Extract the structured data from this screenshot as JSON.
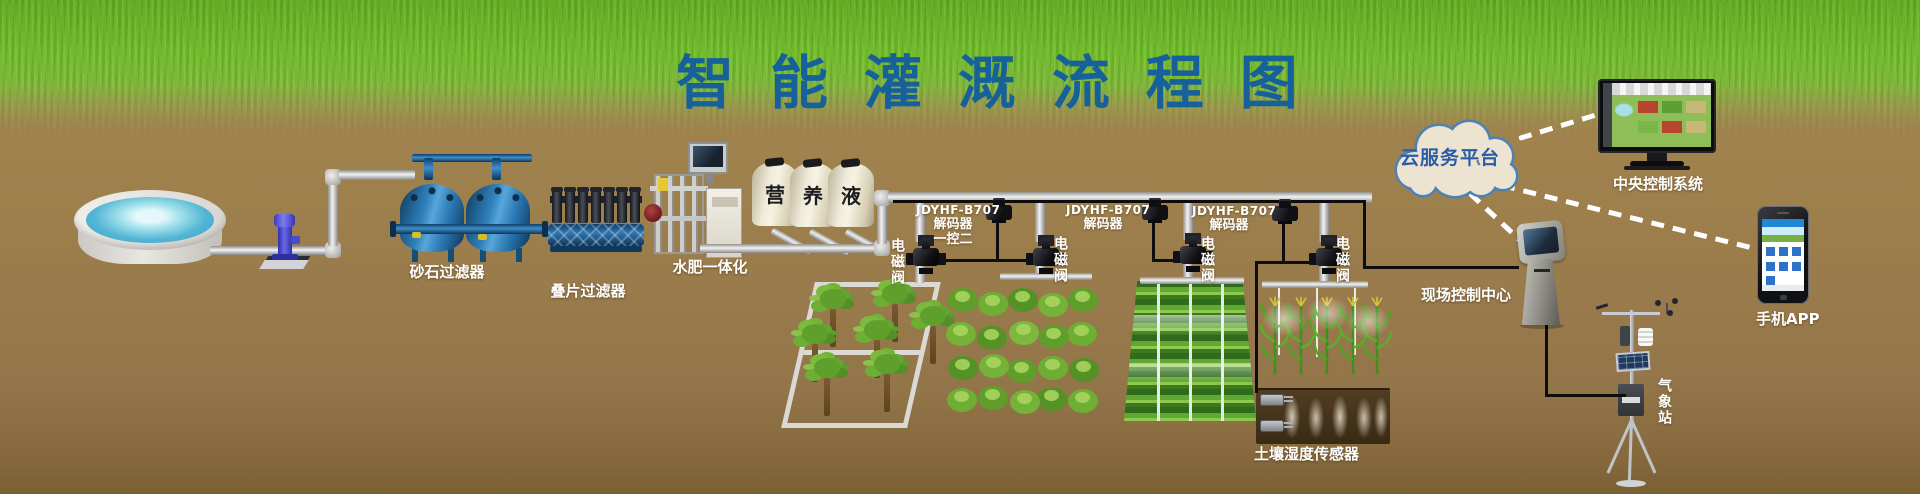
{
  "title": "智能灌溉流程图",
  "stages": {
    "sand_filter": "砂石过滤器",
    "disc_filter": "叠片过滤器",
    "fertilizer_machine": "水肥一体化",
    "solenoid_valve": "电磁阀",
    "soil_sensor": "土壤湿度传感器"
  },
  "nutrient_tanks": [
    "营",
    "养",
    "液"
  ],
  "decoders": [
    {
      "model": "JDYHF-B707",
      "name": "解码器",
      "mode": "一控二"
    },
    {
      "model": "JDYHF-B707",
      "name": "解码器"
    },
    {
      "model": "JDYHF-B707",
      "name": "解码器"
    }
  ],
  "platform": {
    "cloud": "云服务平台",
    "central_system": "中央控制系统",
    "mobile_app": "手机APP",
    "field_center": "现场控制中心",
    "weather_station": "气象站"
  },
  "colors": {
    "title_blue": "#17619b",
    "grass_green": "#72bd2d",
    "soil_brown": "#9b7c4c",
    "cloud_fill": "#ece4d0",
    "cloud_border": "#4d82b8",
    "cloud_text": "#2a5ca8",
    "label_white": "#ffffff",
    "filter_tank_blue": "#2f81bd",
    "pump_blue": "#4343c6"
  }
}
